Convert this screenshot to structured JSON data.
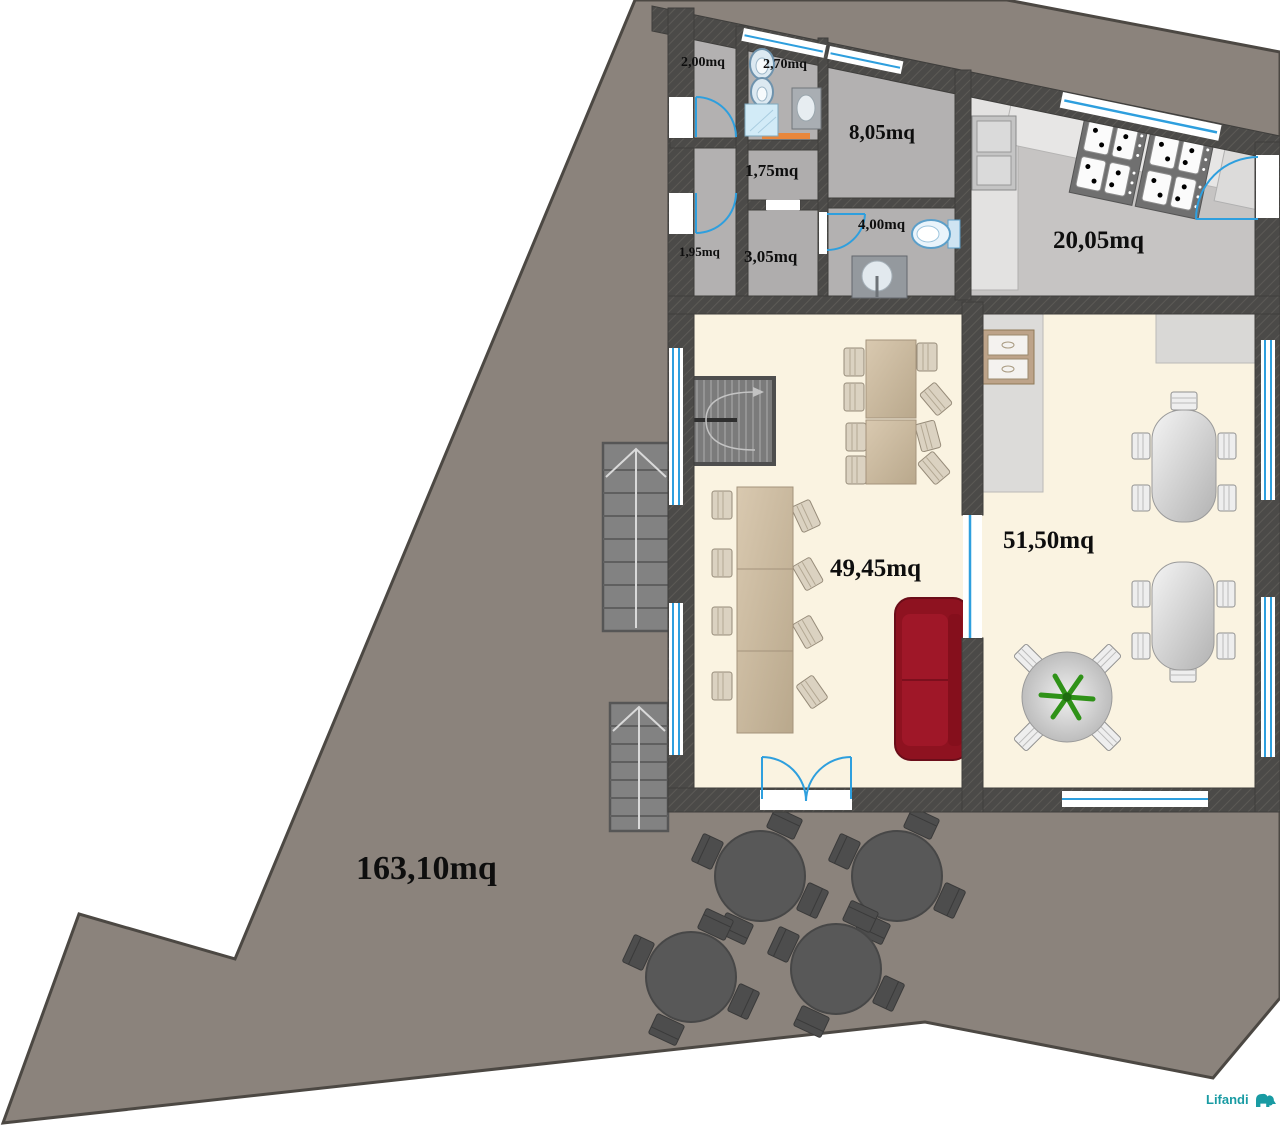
{
  "plan": {
    "type": "architectural-floor-plan",
    "area_unit": "mq"
  },
  "labels": {
    "room_200": "2,00mq",
    "room_270": "2,70mq",
    "room_805": "8,05mq",
    "corridor_175": "1,75mq",
    "room_195": "1,95mq",
    "corridor_305": "3,05mq",
    "bath_400": "4,00mq",
    "kitchen_2005": "20,05mq",
    "hall_4945": "49,45mq",
    "dining_5150": "51,50mq",
    "terrace_16310": "163,10mq"
  },
  "branding": {
    "logo_text": "Lifandi",
    "logo_color": "#199BA3",
    "logo_icon": "elephant-icon"
  },
  "colors": {
    "terrain": "#8B837C",
    "terrain_border": "#4C4843",
    "wall": "#4B4A48",
    "floor_utility": "#B3B1B1",
    "floor_kitchen": "#C6C4C3",
    "floor_cream": "#FAF3E1",
    "window_blue": "#2E9FDE",
    "door_orange": "#E8873C",
    "sofa_red": "#8E1220",
    "table_beige": "#CBB99F",
    "plant_green": "#2F9218"
  }
}
